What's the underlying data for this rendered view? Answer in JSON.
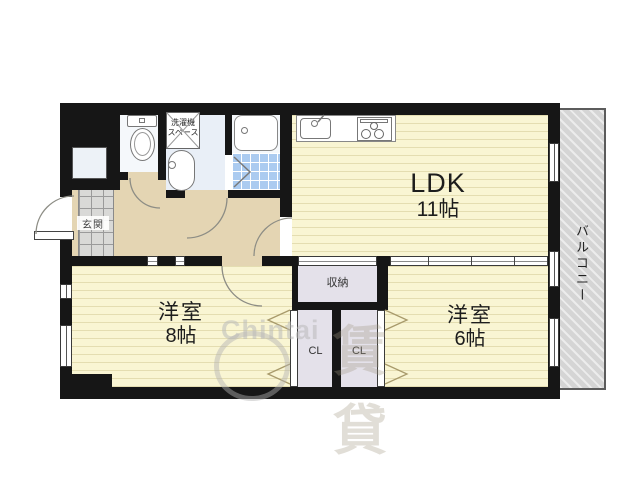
{
  "floorplan": {
    "rooms": {
      "ldk": {
        "label": "LDK",
        "size": "11帖"
      },
      "western8": {
        "label": "洋室",
        "size": "8帖"
      },
      "western6": {
        "label": "洋室",
        "size": "6帖"
      },
      "storage": {
        "label": "収納"
      },
      "closet_left": {
        "label": "CL"
      },
      "closet_right": {
        "label": "CL"
      },
      "entrance": {
        "label": "玄関"
      },
      "laundry": {
        "line1": "洗濯機",
        "line2": "スペース"
      },
      "balcony": {
        "label": "バルコニー"
      }
    },
    "watermark": {
      "brand": "Chintai",
      "kanji": "賃貸"
    },
    "colors": {
      "wall": "#161616",
      "room_yellow": "#f9f5d3",
      "hall_beige": "#e4d5b3",
      "wet_blue": "#e9eff7",
      "bath_tile": "#abcbf0",
      "closet_gray": "#e4e1ea",
      "balcony_gray": "#d5d5d5"
    }
  }
}
